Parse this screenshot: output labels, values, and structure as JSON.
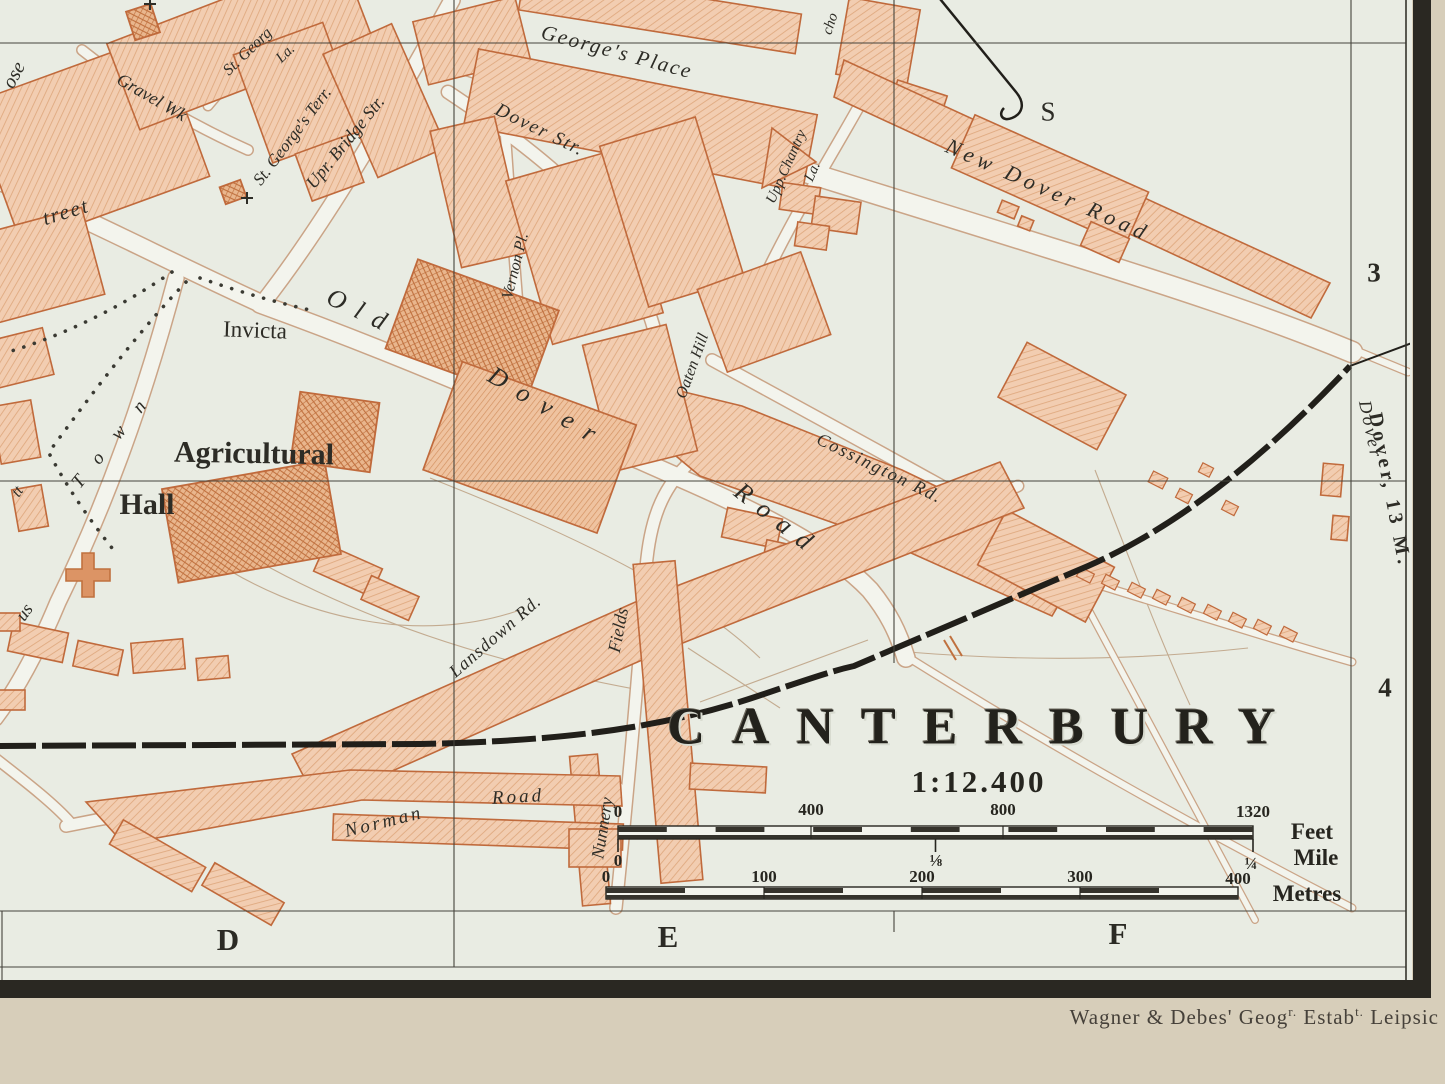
{
  "map": {
    "title": "CANTERBURY",
    "scale_ratio": "1:12.400",
    "grid": {
      "row_labels": [
        "3",
        "4"
      ],
      "col_labels": [
        "D",
        "E",
        "F"
      ]
    },
    "railway": {
      "dover_bold": "Dover, 13 M.",
      "dover_plain": "Dover",
      "s_fragment": "S"
    },
    "streets": {
      "gravel_walk": "Gravel Wk",
      "st_georg_la": "St. Georg",
      "st_georg_la2": "La.",
      "st_georges_terr": "St. George's Terr.",
      "upper_bridge": "Upr. Bridge Str.",
      "georges_place": "George's Place",
      "new_dover_road": "New Dover Road",
      "dover_str": "Dover Str.",
      "vernon_pl": "Vernon Pl.",
      "oaten_hill": "Oaten Hill",
      "upp_chantry": "Upp.Chantry",
      "upp_chantry_la": "La.",
      "cossington_rd": "Cossington Rd.",
      "old": "Old",
      "dover": "Dover",
      "road": "Road",
      "lansdown_rd": "Lansdown Rd.",
      "nunnery": "Nunnery",
      "fields": "Fields",
      "norman": "Norman",
      "norman_road": "Road",
      "town": "Town",
      "town_prefix": "us"
    },
    "fragments": {
      "ose": "ose",
      "treet": "treet",
      "tt": "tt",
      "cho": "cho"
    },
    "places": {
      "invicta": "Invicta",
      "agricultural": "Agricultural",
      "hall": "Hall"
    },
    "scale_bars": {
      "feet": {
        "ticks": [
          "0",
          "400",
          "800",
          "1320"
        ],
        "unit": "Feet"
      },
      "mile": {
        "ticks": [
          "0",
          "⅛",
          "¼"
        ],
        "unit": "Mile"
      },
      "metres": {
        "ticks": [
          "0",
          "100",
          "200",
          "300",
          "400"
        ],
        "unit": "Metres"
      }
    }
  },
  "imprint": {
    "part1": "Wagner & Debes' Geog",
    "sup1": "r.",
    "part2": " Estab",
    "sup2": "t.",
    "part3": " Leipsic"
  },
  "colors": {
    "page_tan": "#d7ceba",
    "map_ivory": "#e9ece3",
    "street_white": "#f3f4ed",
    "block_fill": "#f2cdb1",
    "block_line": "#dfa87e",
    "block_edge": "#c06a3c",
    "ink": "#2d2c26",
    "railway_black": "#211f1a",
    "grid_line": "#45443c"
  }
}
